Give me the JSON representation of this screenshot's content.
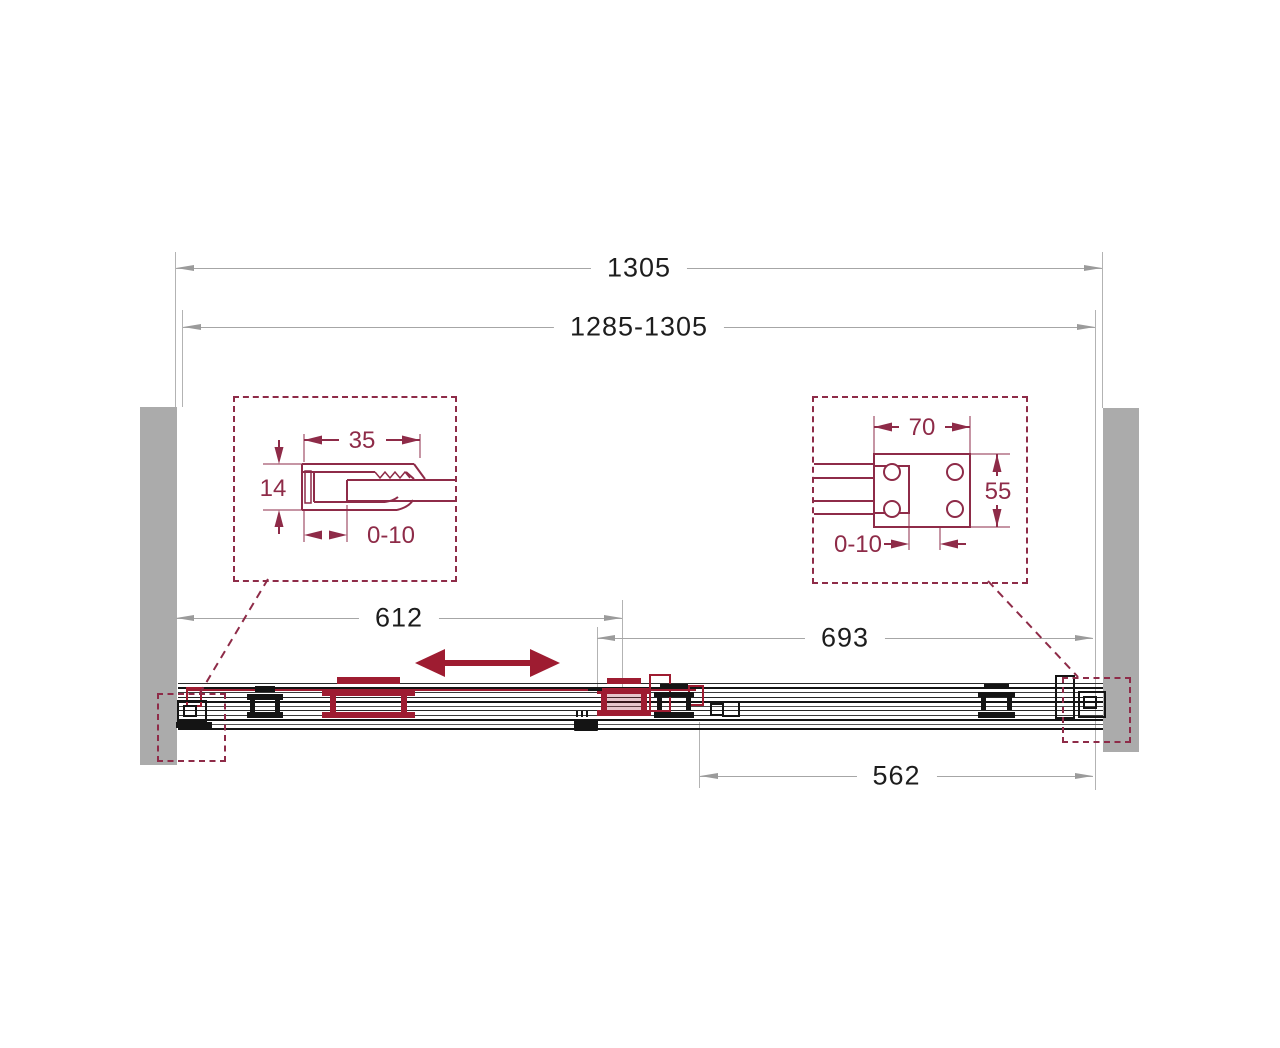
{
  "diagram": {
    "type": "technical-drawing",
    "subject": "sliding-shower-door-front-elevation"
  },
  "colors": {
    "drawing_maroon": "#8e2b48",
    "accent_crimson": "#9e1c31",
    "wall_gray": "#ababab",
    "dimension_gray": "#a6a6a6",
    "ink": "#1d1d1d"
  },
  "dimensions": {
    "overall": "1305",
    "adjustment_range": "1285-1305",
    "left_opening": "612",
    "right_opening": "693",
    "fixed_panel": "562"
  },
  "left_detail": {
    "profile_width": "35",
    "profile_depth": "14",
    "adjustment": "0-10"
  },
  "right_detail": {
    "bracket_width": "70",
    "bracket_height": "55",
    "adjustment": "0-10"
  },
  "icons": {
    "slide_direction": "double-headed-arrow"
  }
}
